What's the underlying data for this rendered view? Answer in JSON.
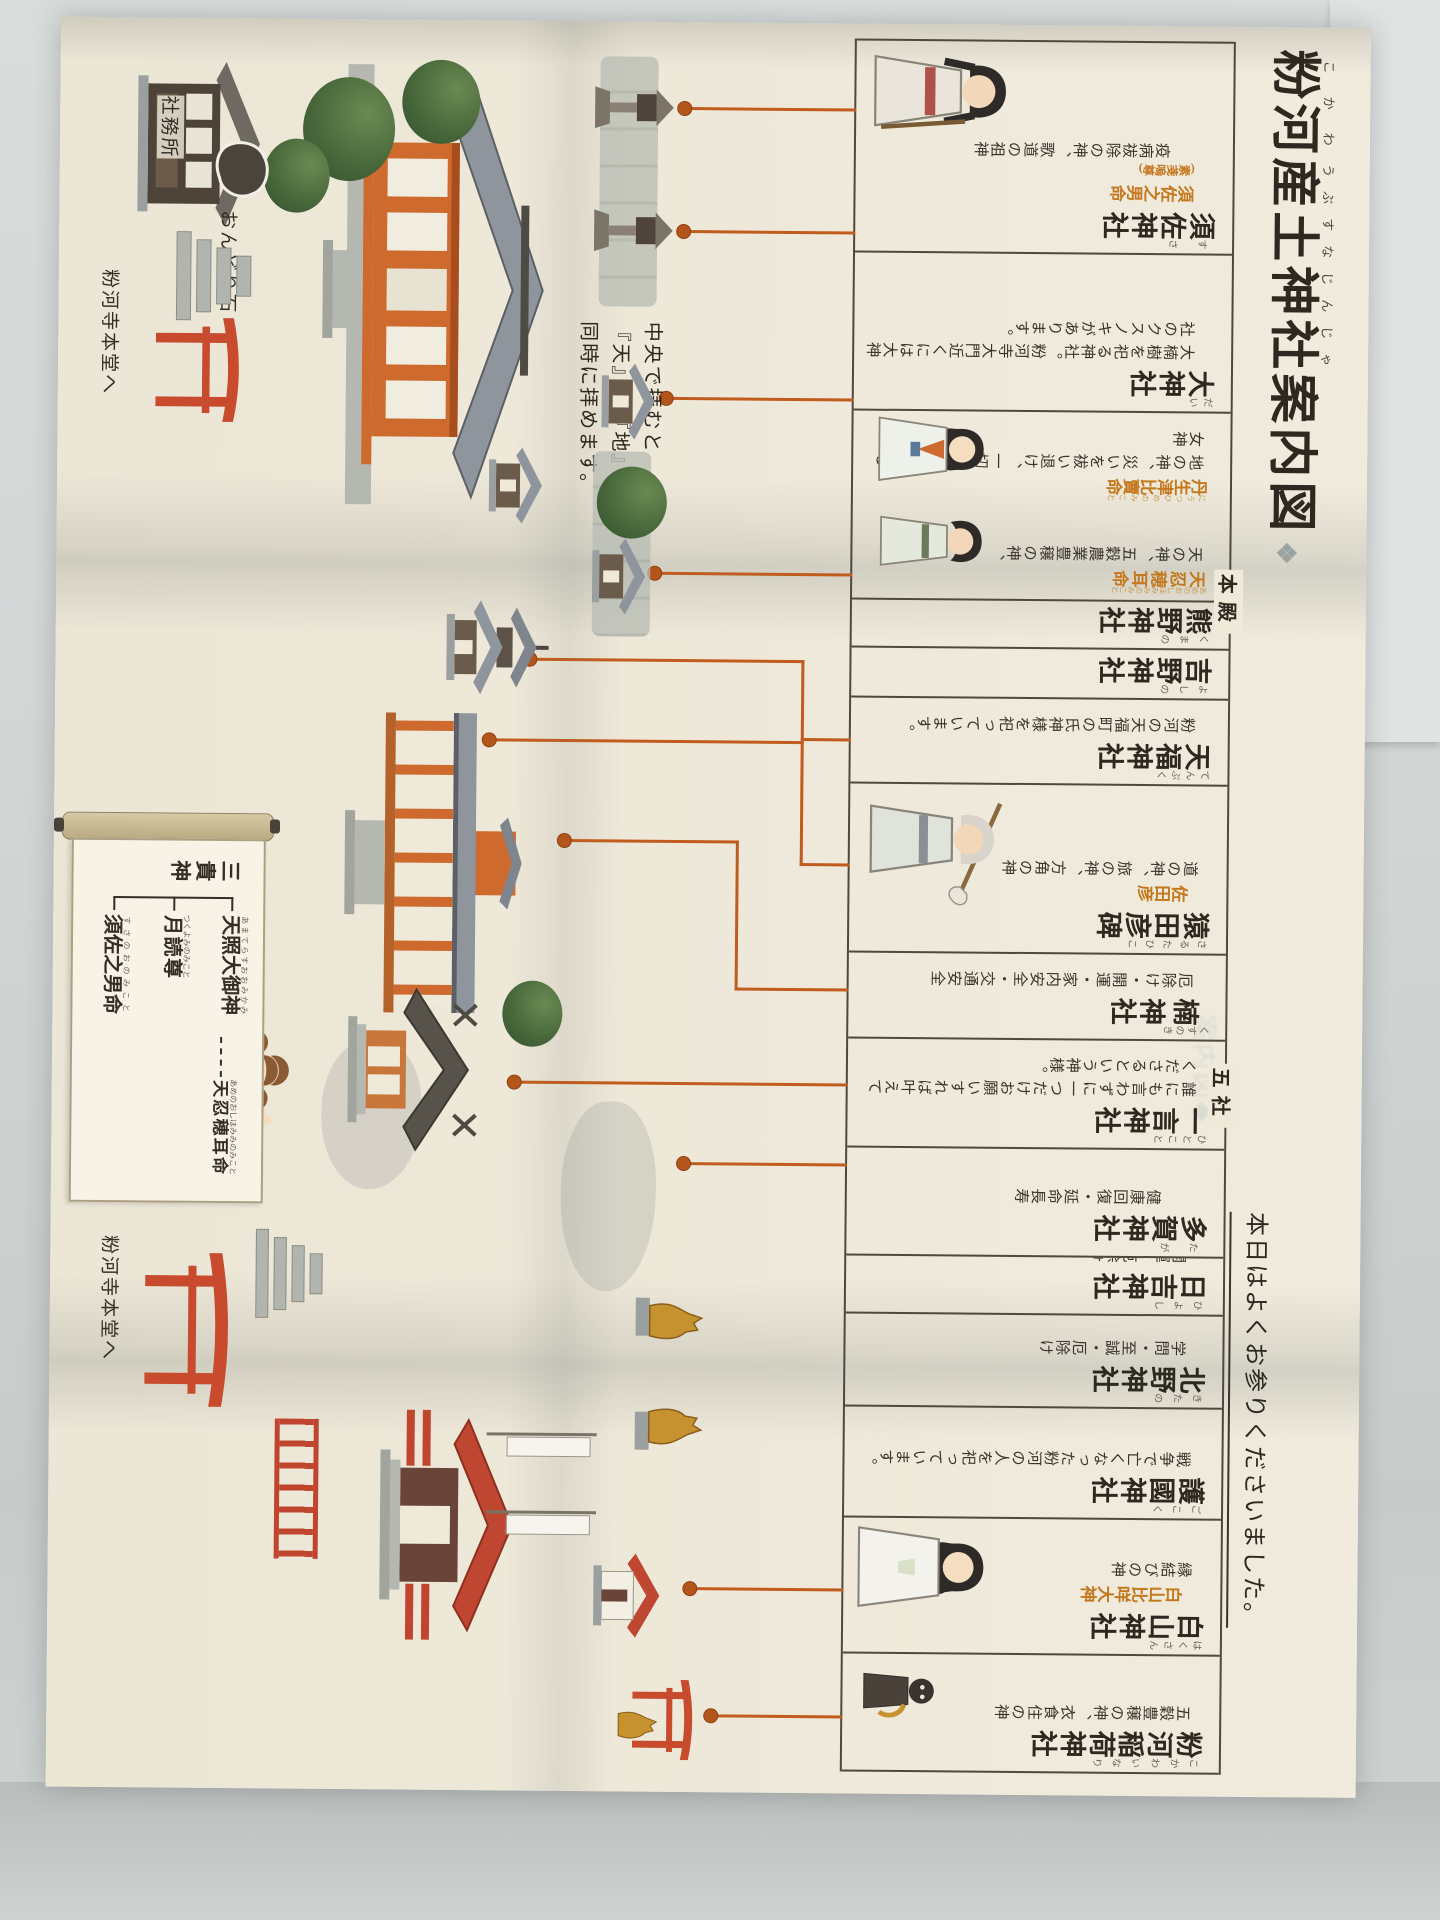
{
  "colors": {
    "background": "#d3d8d7",
    "paper": "#efe9da",
    "accent_orange": "#bf5c1e",
    "deity_orange": "#c4791f",
    "ink": "#332e26"
  },
  "title": {
    "seg1": {
      "base": "粉河",
      "ruby": "こかわ"
    },
    "seg2": {
      "base": "産土",
      "ruby": "うぶすな"
    },
    "seg3": {
      "base": "神社",
      "ruby": "じんじゃ"
    },
    "seg4": {
      "base": "案内図",
      "ruby": ""
    },
    "ornament": "❖"
  },
  "greeting": "本日はよくお参りくださいました。",
  "ghost_text": "案内図◆",
  "table": {
    "honden_label": "本殿",
    "gosha_label": "五社",
    "cells": [
      {
        "base": "須佐",
        "reading": "すさ",
        "suffix": "神社",
        "deity": "須佐之男命",
        "deity_note": "(素戔嗚尊)",
        "desc": "疫病祓除の神、歌道の祖神"
      },
      {
        "base": "大",
        "reading": "だい",
        "suffix": "神社",
        "desc": "大楠樹を祀る神社。粉河寺大門近くには大神社のクスノキがあります。"
      },
      {
        "groups": [
          {
            "deity": "天忍穂耳命",
            "deity_reading": "あめのおしほみみのみこと",
            "desc": "天の神、五穀農業豊穣の神、"
          },
          {
            "deity": "丹生津比賣命",
            "deity_reading": "にうつひめのみこと",
            "desc": "地の神、災いを祓い退け、一切を守り育てる女神"
          }
        ]
      },
      {
        "base": "熊野",
        "reading": "くまの",
        "suffix": "神社"
      },
      {
        "base": "吉野",
        "reading": "よしの",
        "suffix": "神社"
      },
      {
        "base": "天福",
        "reading": "てんぷく",
        "suffix": "神社",
        "desc": "粉河の天福町の氏神様を祀っています。"
      },
      {
        "base": "猿田彦",
        "reading": "さるたひこ",
        "suffix": "碑",
        "deity": "佐田彦",
        "desc": "道の神、旅の神、方角の神"
      },
      {
        "base": "楠",
        "reading": "くすのき",
        "suffix": "神社",
        "desc": "厄除け・開運・家内安全・交通安全"
      },
      {
        "base": "一言",
        "reading": "ひとこと",
        "suffix": "神社",
        "desc": "誰にも言わずに一つだけお願いすれば叶えてくださるという神様。"
      },
      {
        "base": "多賀",
        "reading": "たが",
        "suffix": "神社",
        "desc": "健康回復・延命長寿"
      },
      {
        "base": "日吉",
        "reading": "ひよし",
        "suffix": "神社",
        "desc": "開運・厄除け"
      },
      {
        "base": "北野",
        "reading": "きたの",
        "suffix": "神社",
        "desc": "学問・至誠・厄除け"
      },
      {
        "base": "護國",
        "reading": "ごこく",
        "suffix": "神社",
        "desc": "戦争で亡くなった粉河の人を祀っています。"
      },
      {
        "base": "白山",
        "reading": "はくさん",
        "suffix": "神社",
        "deity": "白山比咩大神",
        "desc": "縁結びの神"
      },
      {
        "base": "粉河稲荷",
        "reading": "こかわいなり",
        "suffix": "神社",
        "desc": "五穀豊穣の神、衣食住の神"
      }
    ]
  },
  "map": {
    "center_note": "中央で拝むと\n『天』と『地』を\n同時に拝めます。",
    "labels": {
      "shamusho": "社務所",
      "ondori_stone": "おんどり石",
      "kokawadera_left": "粉河寺本堂へ",
      "kokawadera_right": "粉河寺本堂へ"
    },
    "scroll": {
      "label": "三貴神",
      "names": [
        {
          "name": "天照大御神",
          "reading": "あまてらすおおみかみ"
        },
        {
          "name": "月読尊",
          "reading": "つくよみのみこと"
        },
        {
          "name": "須佐之男命",
          "reading": "すさのおのみこと"
        }
      ],
      "child": {
        "name": "天忍穂耳命",
        "reading": "あめのおしほみみのみこと"
      }
    }
  }
}
